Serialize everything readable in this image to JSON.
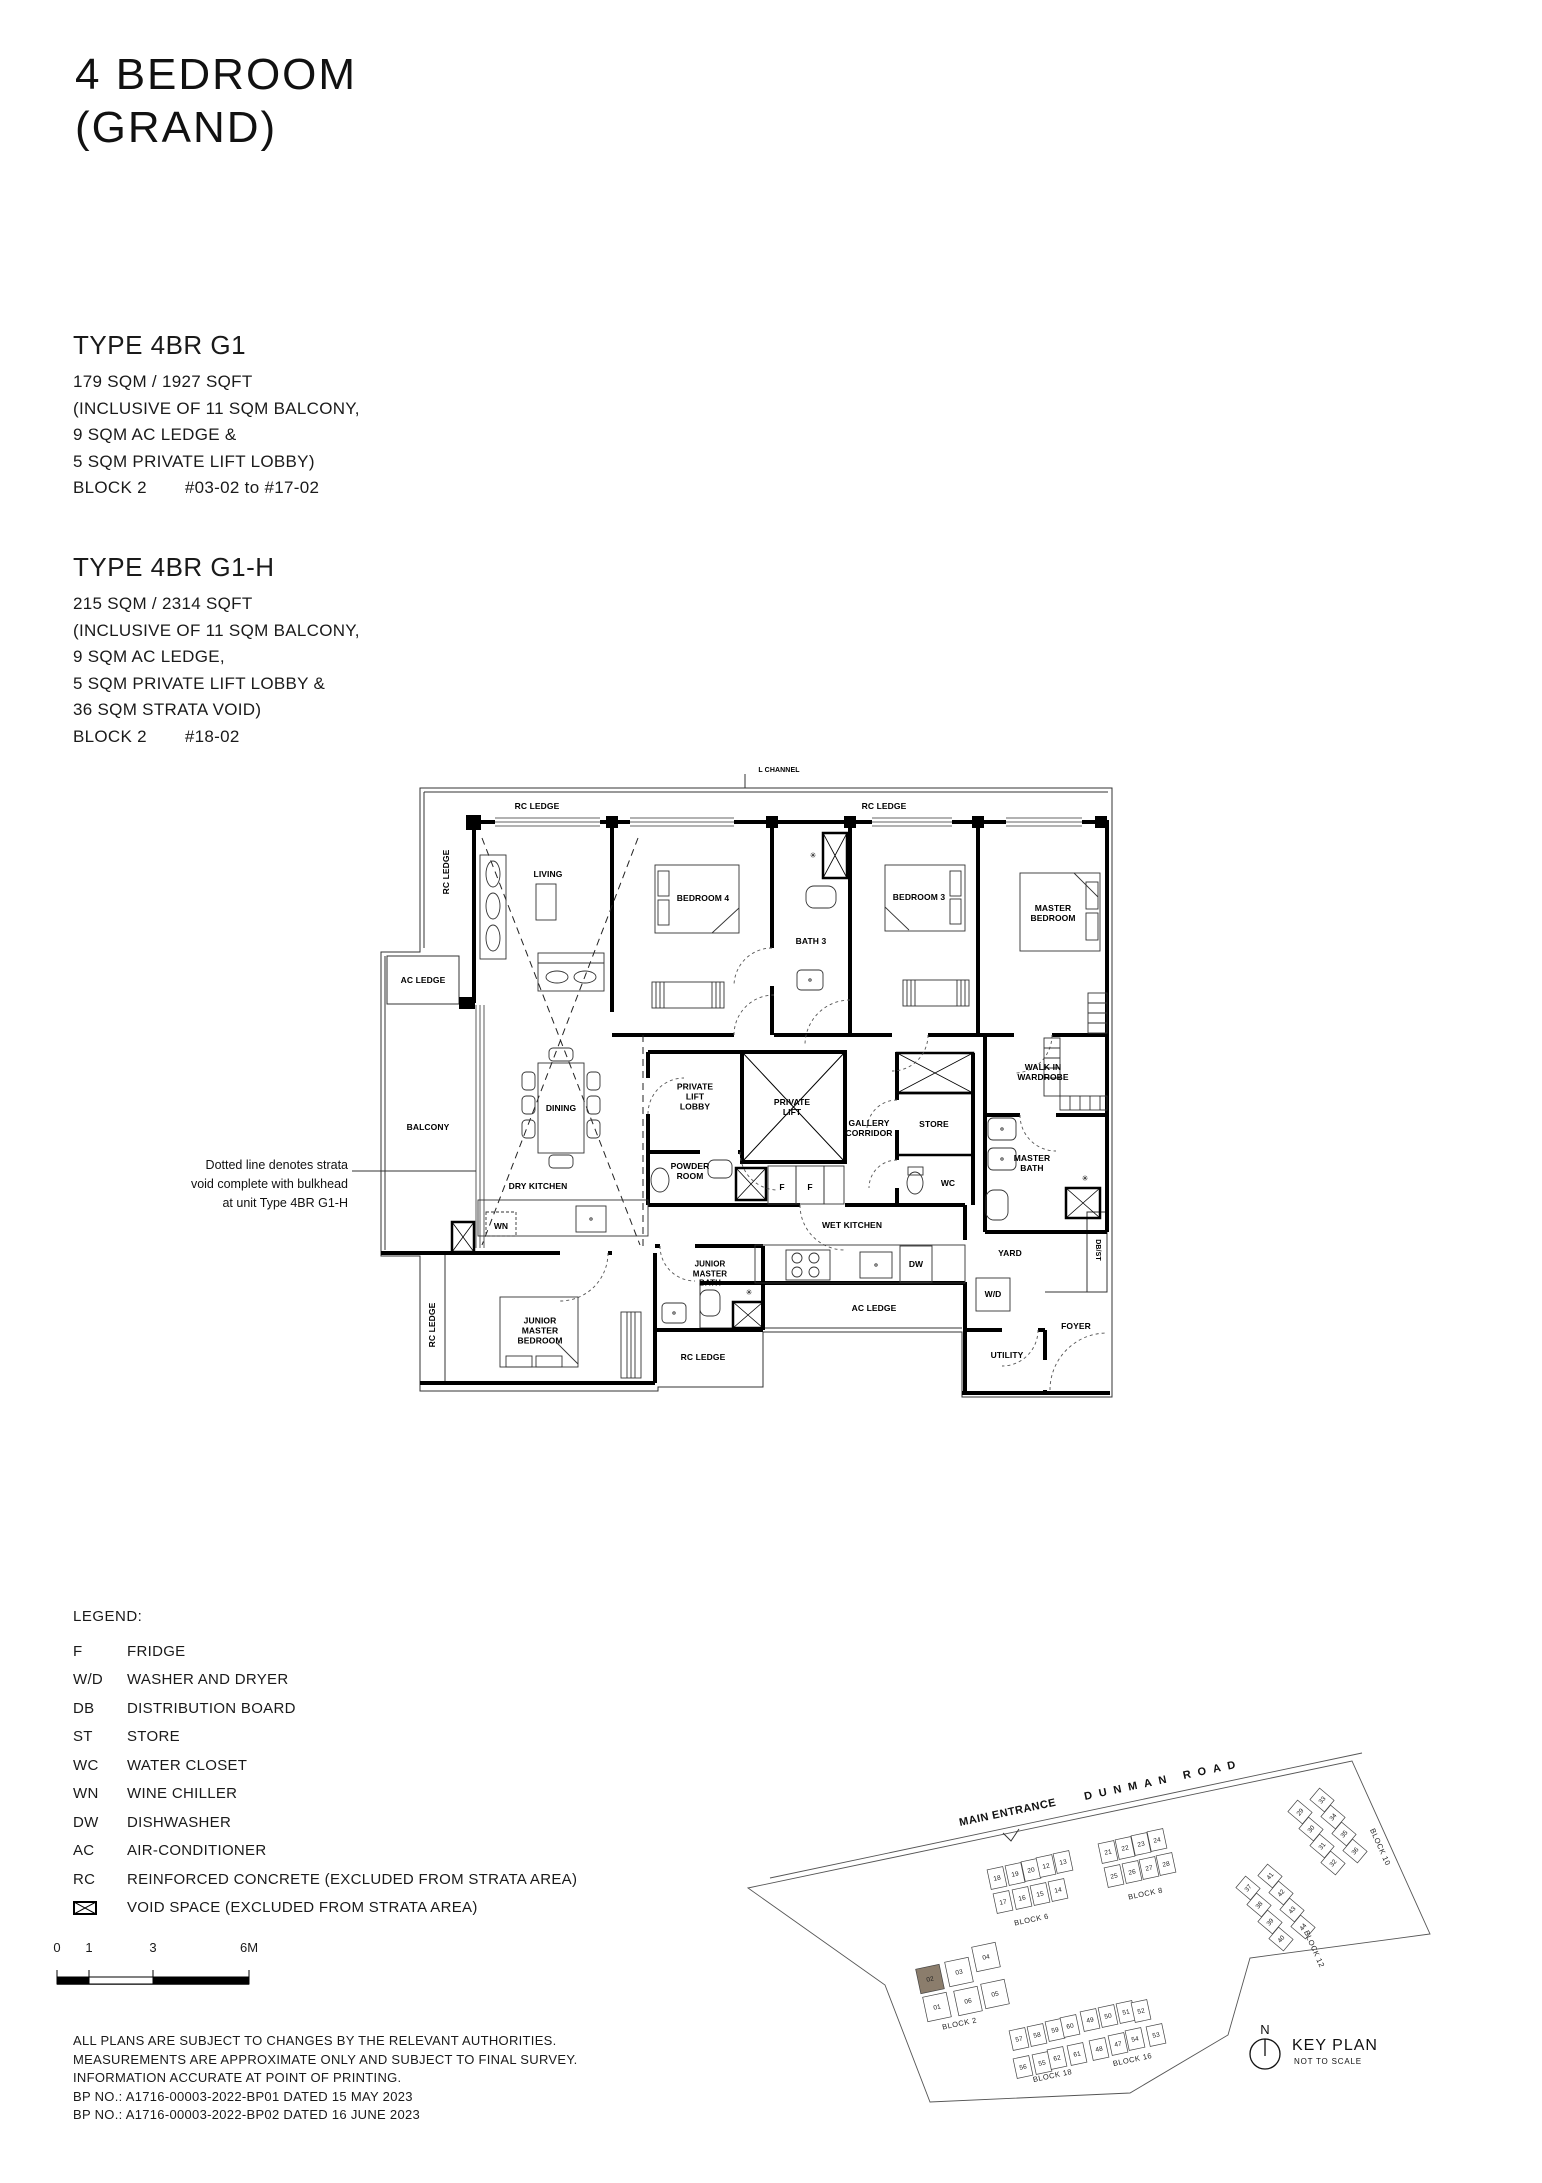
{
  "page": {
    "title_line1": "4 BEDROOM",
    "title_line2": "(GRAND)"
  },
  "type1": {
    "name": "TYPE 4BR G1",
    "lines": [
      "179 SQM / 1927 SQFT",
      "(INCLUSIVE OF 11 SQM BALCONY,",
      "9 SQM AC LEDGE &",
      "5 SQM PRIVATE LIFT LOBBY)"
    ],
    "block_label": "BLOCK 2",
    "units": "#03-02 to #17-02"
  },
  "type2": {
    "name": "TYPE 4BR G1-H",
    "lines": [
      "215 SQM / 2314 SQFT",
      "(INCLUSIVE OF 11 SQM BALCONY,",
      "9 SQM AC LEDGE,",
      "5 SQM PRIVATE LIFT LOBBY &",
      "36 SQM STRATA VOID)"
    ],
    "block_label": "BLOCK 2",
    "units": "#18-02"
  },
  "floorplan": {
    "annotation_lines": [
      "Dotted line denotes strata",
      "void complete with bulkhead",
      "at unit Type 4BR G1-H"
    ],
    "labels": [
      {
        "t": "L CHANNEL",
        "x": 779,
        "y": 771,
        "s": 7
      },
      {
        "t": "RC LEDGE",
        "x": 537,
        "y": 806
      },
      {
        "t": "RC LEDGE",
        "x": 884,
        "y": 806
      },
      {
        "t": "RC LEDGE",
        "x": 446,
        "y": 872,
        "r": -90
      },
      {
        "t": "LIVING",
        "x": 548,
        "y": 874
      },
      {
        "t": "BEDROOM 4",
        "x": 703,
        "y": 898
      },
      {
        "t": "BATH 3",
        "x": 811,
        "y": 941
      },
      {
        "t": "BEDROOM 3",
        "x": 919,
        "y": 897
      },
      {
        "t": "MASTER\nBEDROOM",
        "x": 1053,
        "y": 913
      },
      {
        "t": "AC LEDGE",
        "x": 423,
        "y": 980
      },
      {
        "t": "BALCONY",
        "x": 428,
        "y": 1127
      },
      {
        "t": "DINING",
        "x": 561,
        "y": 1108
      },
      {
        "t": "PRIVATE\nLIFT\nLOBBY",
        "x": 695,
        "y": 1097
      },
      {
        "t": "PRIVATE\nLIFT",
        "x": 792,
        "y": 1107
      },
      {
        "t": "GALLERY\nCORRIDOR",
        "x": 869,
        "y": 1128
      },
      {
        "t": "STORE",
        "x": 934,
        "y": 1124
      },
      {
        "t": "WALK IN\nWARDROBE",
        "x": 1043,
        "y": 1072
      },
      {
        "t": "MASTER\nBATH",
        "x": 1032,
        "y": 1163
      },
      {
        "t": "WC",
        "x": 948,
        "y": 1183
      },
      {
        "t": "POWDER\nROOM",
        "x": 690,
        "y": 1171
      },
      {
        "t": "F",
        "x": 782,
        "y": 1187
      },
      {
        "t": "F",
        "x": 810,
        "y": 1187
      },
      {
        "t": "DRY KITCHEN",
        "x": 538,
        "y": 1186
      },
      {
        "t": "WN",
        "x": 501,
        "y": 1226
      },
      {
        "t": "WET KITCHEN",
        "x": 852,
        "y": 1225
      },
      {
        "t": "DW",
        "x": 916,
        "y": 1264
      },
      {
        "t": "YARD",
        "x": 1010,
        "y": 1253
      },
      {
        "t": "DB/ST",
        "x": 1097,
        "y": 1250,
        "r": 90,
        "s": 7
      },
      {
        "t": "W/D",
        "x": 993,
        "y": 1294
      },
      {
        "t": "AC LEDGE",
        "x": 874,
        "y": 1308
      },
      {
        "t": "JUNIOR\nMASTER\nBATH",
        "x": 710,
        "y": 1274,
        "s": 8
      },
      {
        "t": "JUNIOR\nMASTER\nBEDROOM",
        "x": 540,
        "y": 1331
      },
      {
        "t": "RC LEDGE",
        "x": 703,
        "y": 1357
      },
      {
        "t": "RC LEDGE",
        "x": 432,
        "y": 1325,
        "r": -90
      },
      {
        "t": "UTILITY",
        "x": 1007,
        "y": 1355
      },
      {
        "t": "FOYER",
        "x": 1076,
        "y": 1326
      },
      {
        "t": "✳",
        "x": 813,
        "y": 856,
        "s": 8
      },
      {
        "t": "✳",
        "x": 1085,
        "y": 1179,
        "s": 8
      },
      {
        "t": "✳",
        "x": 749,
        "y": 1293,
        "s": 8
      }
    ]
  },
  "legend": {
    "title": "LEGEND:",
    "items": [
      {
        "abbr": "F",
        "desc": "FRIDGE"
      },
      {
        "abbr": "W/D",
        "desc": "WASHER AND DRYER"
      },
      {
        "abbr": "DB",
        "desc": "DISTRIBUTION BOARD"
      },
      {
        "abbr": "ST",
        "desc": "STORE"
      },
      {
        "abbr": "WC",
        "desc": "WATER CLOSET"
      },
      {
        "abbr": "WN",
        "desc": "WINE CHILLER"
      },
      {
        "abbr": "DW",
        "desc": "DISHWASHER"
      },
      {
        "abbr": "AC",
        "desc": "AIR-CONDITIONER"
      },
      {
        "abbr": "RC",
        "desc": "REINFORCED CONCRETE (EXCLUDED FROM STRATA AREA)"
      }
    ],
    "void_desc": "VOID SPACE (EXCLUDED FROM STRATA AREA)"
  },
  "scalebar": {
    "ticks": [
      "0",
      "1",
      "3",
      "6M"
    ]
  },
  "disclaimer": {
    "lines": [
      "ALL PLANS ARE SUBJECT TO CHANGES BY THE RELEVANT AUTHORITIES.",
      "MEASUREMENTS ARE APPROXIMATE ONLY AND SUBJECT TO FINAL SURVEY.",
      "INFORMATION ACCURATE AT POINT OF PRINTING.",
      "BP NO.: A1716-00003-2022-BP01 DATED 15 MAY 2023",
      "BP NO.: A1716-00003-2022-BP02 DATED 16 JUNE 2023"
    ]
  },
  "keyplan": {
    "main_entrance": "MAIN ENTRANCE",
    "road_name": "DUNMAN ROAD",
    "title": "KEY PLAN",
    "subtitle": "NOT TO SCALE",
    "north_label": "N",
    "highlight_color": "#8B7D6C",
    "highlighted_unit": "02",
    "blocks": [
      {
        "name": "BLOCK 6",
        "label_x": 1032,
        "label_y": 1922,
        "label_rot": -12,
        "rot": -12,
        "uw": 16,
        "uh": 20,
        "units": [
          {
            "n": "18",
            "x": 997,
            "y": 1878
          },
          {
            "n": "19",
            "x": 1015,
            "y": 1874
          },
          {
            "n": "20",
            "x": 1031,
            "y": 1870
          },
          {
            "n": "12",
            "x": 1046,
            "y": 1866
          },
          {
            "n": "13",
            "x": 1063,
            "y": 1862
          },
          {
            "n": "17",
            "x": 1003,
            "y": 1902
          },
          {
            "n": "16",
            "x": 1022,
            "y": 1898
          },
          {
            "n": "15",
            "x": 1040,
            "y": 1894
          },
          {
            "n": "14",
            "x": 1058,
            "y": 1890
          }
        ]
      },
      {
        "name": "BLOCK 8",
        "label_x": 1146,
        "label_y": 1896,
        "label_rot": -12,
        "rot": -12,
        "uw": 16,
        "uh": 20,
        "units": [
          {
            "n": "21",
            "x": 1108,
            "y": 1852
          },
          {
            "n": "22",
            "x": 1125,
            "y": 1848
          },
          {
            "n": "23",
            "x": 1141,
            "y": 1844
          },
          {
            "n": "24",
            "x": 1157,
            "y": 1840
          },
          {
            "n": "25",
            "x": 1114,
            "y": 1876
          },
          {
            "n": "26",
            "x": 1132,
            "y": 1872
          },
          {
            "n": "27",
            "x": 1149,
            "y": 1868
          },
          {
            "n": "28",
            "x": 1166,
            "y": 1864
          }
        ]
      },
      {
        "name": "BLOCK 10",
        "label_x": 1378,
        "label_y": 1848,
        "label_rot": 66,
        "rot": -50,
        "uw": 15,
        "uh": 19,
        "units": [
          {
            "n": "29",
            "x": 1300,
            "y": 1812
          },
          {
            "n": "30",
            "x": 1311,
            "y": 1829
          },
          {
            "n": "31",
            "x": 1322,
            "y": 1846
          },
          {
            "n": "32",
            "x": 1333,
            "y": 1863
          },
          {
            "n": "33",
            "x": 1322,
            "y": 1800
          },
          {
            "n": "34",
            "x": 1333,
            "y": 1817
          },
          {
            "n": "35",
            "x": 1344,
            "y": 1834
          },
          {
            "n": "36",
            "x": 1355,
            "y": 1851
          }
        ]
      },
      {
        "name": "BLOCK 12",
        "label_x": 1312,
        "label_y": 1950,
        "label_rot": 66,
        "rot": -50,
        "uw": 15,
        "uh": 19,
        "units": [
          {
            "n": "37",
            "x": 1248,
            "y": 1888
          },
          {
            "n": "38",
            "x": 1259,
            "y": 1905
          },
          {
            "n": "39",
            "x": 1270,
            "y": 1922
          },
          {
            "n": "40",
            "x": 1281,
            "y": 1939
          },
          {
            "n": "41",
            "x": 1270,
            "y": 1876
          },
          {
            "n": "42",
            "x": 1281,
            "y": 1893
          },
          {
            "n": "43",
            "x": 1292,
            "y": 1910
          },
          {
            "n": "44",
            "x": 1303,
            "y": 1927
          }
        ]
      },
      {
        "name": "BLOCK 2",
        "label_x": 960,
        "label_y": 2026,
        "label_rot": -12,
        "rot": -12,
        "uw": 24,
        "uh": 25,
        "units": [
          {
            "n": "04",
            "x": 986,
            "y": 1957
          },
          {
            "n": "03",
            "x": 959,
            "y": 1972
          },
          {
            "n": "02",
            "x": 930,
            "y": 1979,
            "hl": true
          },
          {
            "n": "05",
            "x": 995,
            "y": 1994
          },
          {
            "n": "06",
            "x": 968,
            "y": 2001
          },
          {
            "n": "01",
            "x": 937,
            "y": 2007
          }
        ]
      },
      {
        "name": "BLOCK 18",
        "label_x": 1053,
        "label_y": 2078,
        "label_rot": -12,
        "rot": -12,
        "uw": 16,
        "uh": 20,
        "units": [
          {
            "n": "57",
            "x": 1019,
            "y": 2039
          },
          {
            "n": "58",
            "x": 1037,
            "y": 2035
          },
          {
            "n": "59",
            "x": 1055,
            "y": 2030
          },
          {
            "n": "60",
            "x": 1070,
            "y": 2026
          },
          {
            "n": "56",
            "x": 1023,
            "y": 2067
          },
          {
            "n": "55",
            "x": 1042,
            "y": 2063
          },
          {
            "n": "62",
            "x": 1057,
            "y": 2058
          },
          {
            "n": "61",
            "x": 1077,
            "y": 2054
          }
        ]
      },
      {
        "name": "BLOCK 16",
        "label_x": 1133,
        "label_y": 2062,
        "label_rot": -12,
        "rot": -12,
        "uw": 16,
        "uh": 20,
        "units": [
          {
            "n": "49",
            "x": 1090,
            "y": 2020
          },
          {
            "n": "50",
            "x": 1108,
            "y": 2016
          },
          {
            "n": "51",
            "x": 1126,
            "y": 2012
          },
          {
            "n": "52",
            "x": 1141,
            "y": 2011
          },
          {
            "n": "48",
            "x": 1099,
            "y": 2049
          },
          {
            "n": "47",
            "x": 1118,
            "y": 2044
          },
          {
            "n": "54",
            "x": 1135,
            "y": 2039
          },
          {
            "n": "53",
            "x": 1156,
            "y": 2035
          }
        ]
      }
    ]
  }
}
